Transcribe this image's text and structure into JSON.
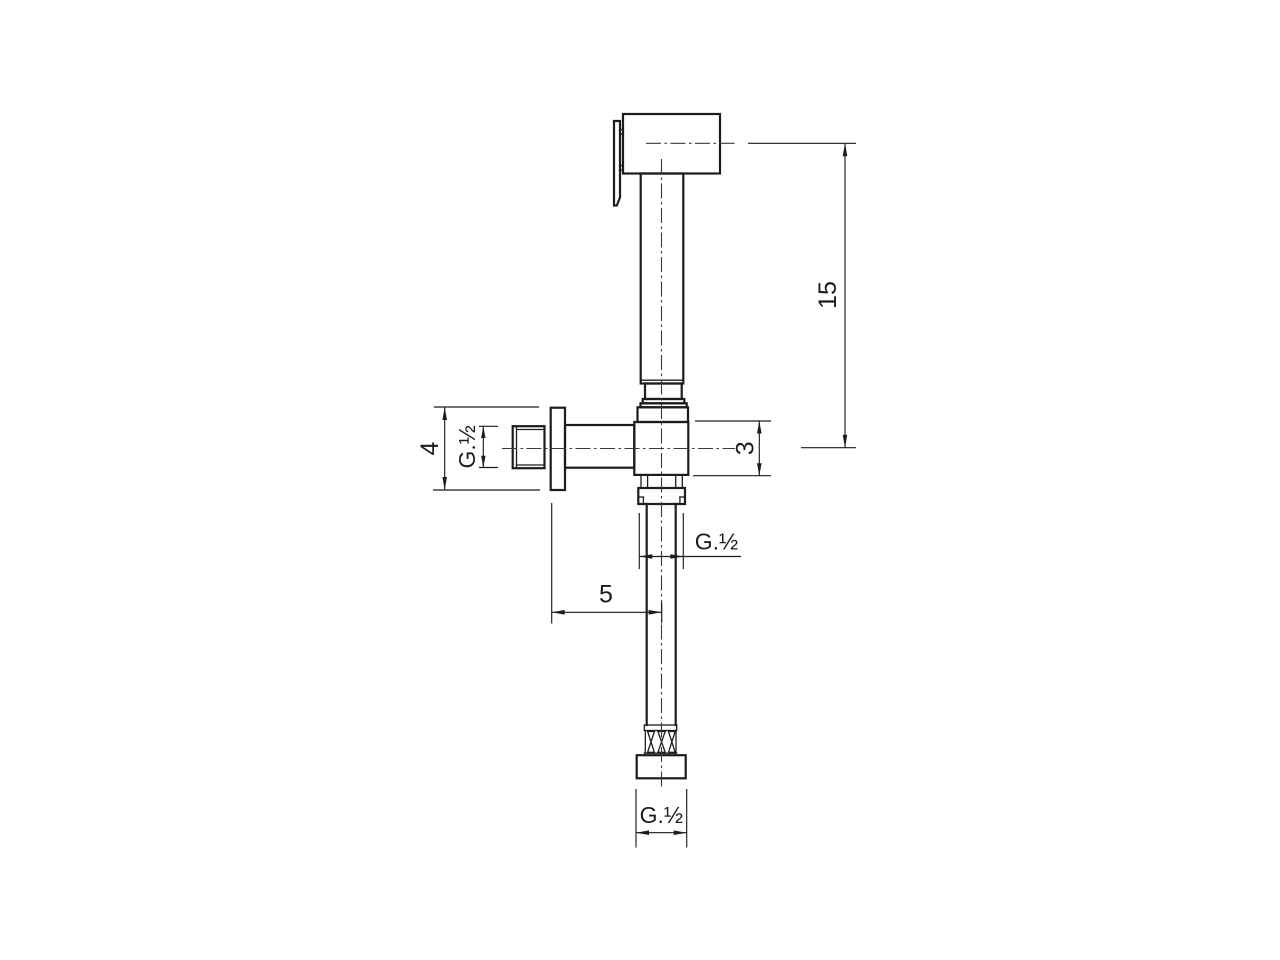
{
  "drawing": {
    "description": "Technical dimension drawing of a wall-mounted angle shut-off valve with hand sprayer (bidet shower set), front view",
    "background_color": "#ffffff",
    "line_color": "#1c1c1c",
    "dimensions": {
      "sprayer_axis_to_valve_axis": "15",
      "flange_height": "4",
      "valve_body_height": "3",
      "flange_to_pipe_axis": "5",
      "inlet_thread": "G.½",
      "outlet_thread": "G.½",
      "bottom_connector_thread": "G.½"
    }
  }
}
